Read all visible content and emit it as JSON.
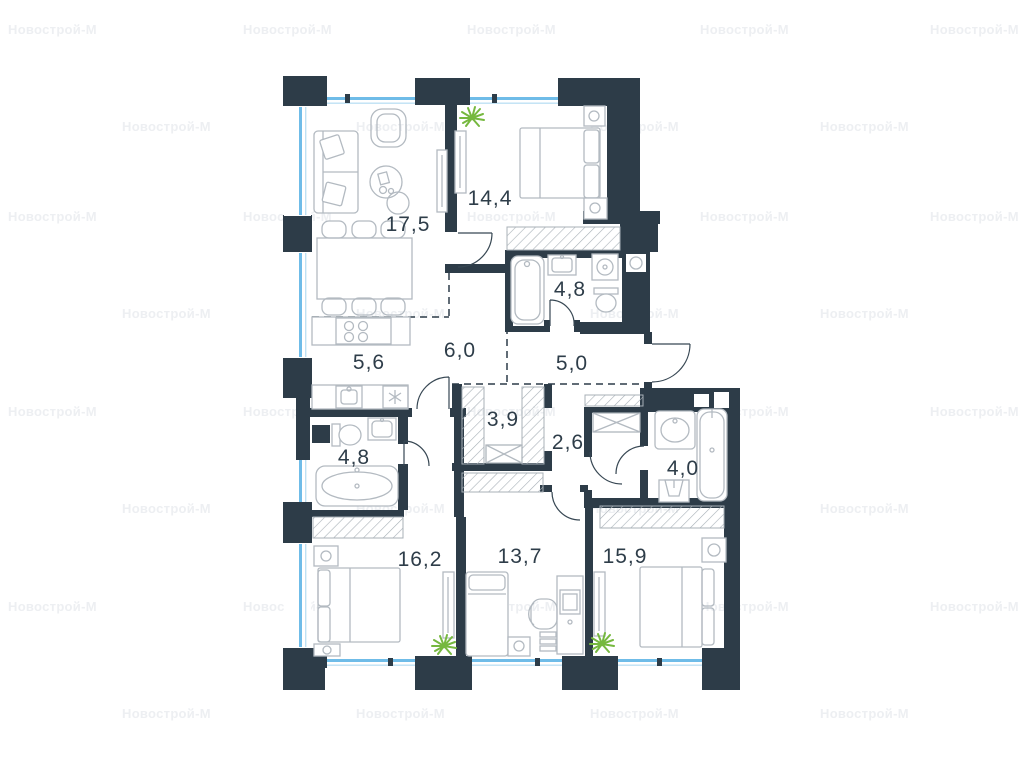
{
  "watermark": {
    "text": "Новострой-М"
  },
  "plan": {
    "rooms": [
      {
        "name": "living-room",
        "area": "17,5"
      },
      {
        "name": "bedroom-top",
        "area": "14,4"
      },
      {
        "name": "bathroom-top",
        "area": "4,8"
      },
      {
        "name": "kitchen",
        "area": "5,6"
      },
      {
        "name": "corridor",
        "area": "6,0"
      },
      {
        "name": "hallway",
        "area": "5,0"
      },
      {
        "name": "closet-left",
        "area": "3,9"
      },
      {
        "name": "closet-right",
        "area": "2,6"
      },
      {
        "name": "bathroom-left",
        "area": "4,8"
      },
      {
        "name": "bathroom-right",
        "area": "4,0"
      },
      {
        "name": "bedroom-left",
        "area": "16,2"
      },
      {
        "name": "room-middle",
        "area": "13,7"
      },
      {
        "name": "bedroom-right",
        "area": "15,9"
      }
    ],
    "colors": {
      "wall": "#2d3c48",
      "window": "#6fbce8",
      "furniture": "#b3bac1",
      "label": "#2e3d49",
      "plant": "#76b83f",
      "watermark": "#edeff2"
    }
  }
}
